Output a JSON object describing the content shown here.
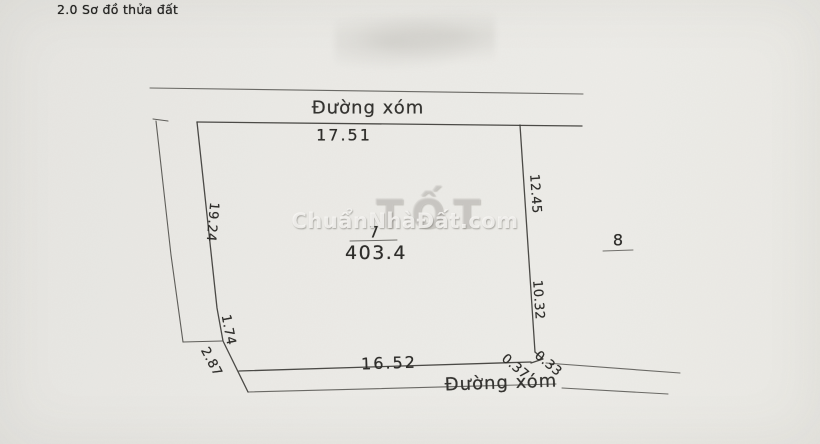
{
  "title": "2.0 Sơ đồ thửa đất",
  "roads": {
    "top": "Đường xóm",
    "bottom": "Đường xóm"
  },
  "parcel": {
    "number": "7",
    "area": "403.4"
  },
  "adjacent_parcel": {
    "number": "8"
  },
  "dimensions": {
    "top": "17.51",
    "left": "19.24",
    "left_seg_1": "1.74",
    "left_seg_2": "2.87",
    "right_upper": "12.45",
    "right_lower": "10.32",
    "corner_seg_a": "0.33",
    "corner_seg_b": "0.37",
    "bottom": "16.52"
  },
  "watermark": {
    "site": "ChuẩnNhàĐất.com",
    "ghost": "TỐT"
  },
  "colors": {
    "paper": "#eae9e5",
    "line_dark": "#3d3c38",
    "line_light": "#5c5b56",
    "text": "#2e2d2a",
    "watermark": "#cfccc5"
  }
}
